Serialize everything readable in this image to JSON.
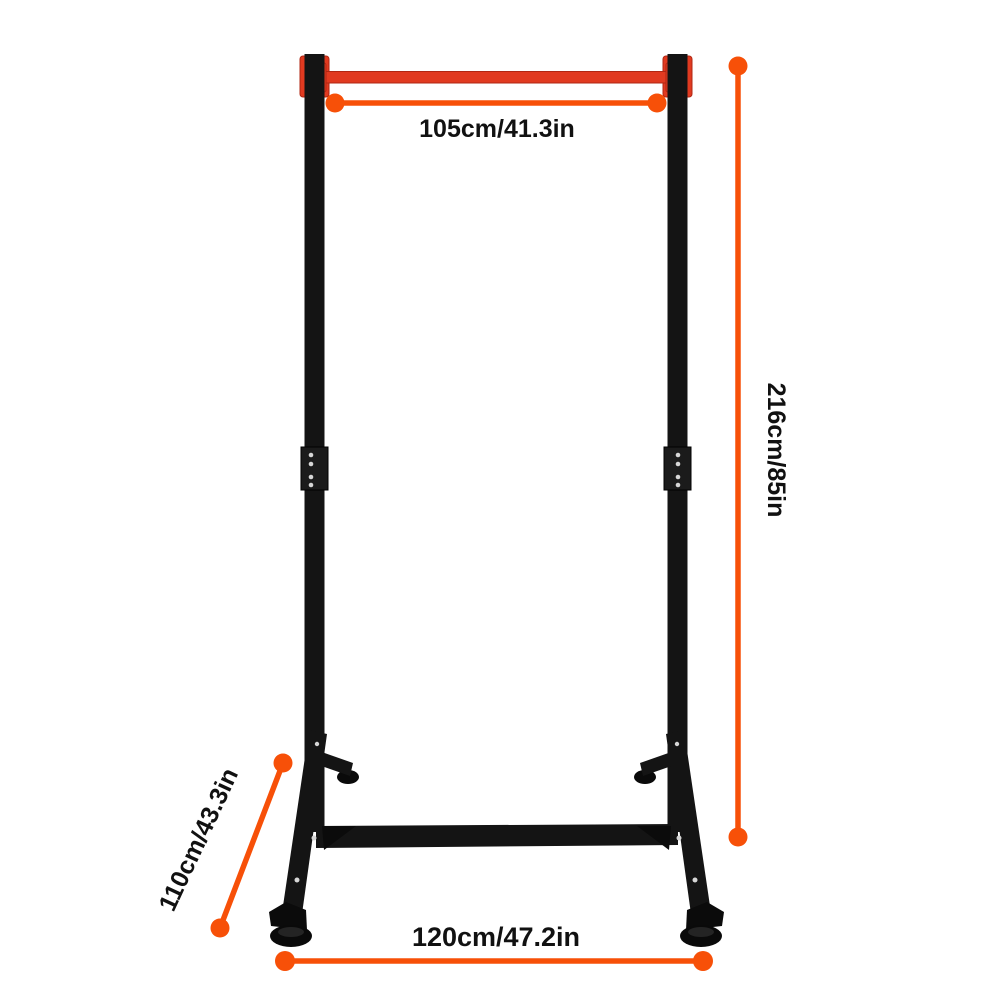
{
  "diagram": {
    "background": "#FFFFFF",
    "colors": {
      "dimension_accent": "#F75008",
      "bar_red": "#E13A20",
      "frame_black": "#141414",
      "label_text": "#111111",
      "background": "#FFFFFF"
    },
    "dimensions": {
      "top_width": "105cm/41.3in",
      "height": "216cm/85in",
      "depth": "110cm/43.3in",
      "base_width": "120cm/47.2in"
    }
  }
}
